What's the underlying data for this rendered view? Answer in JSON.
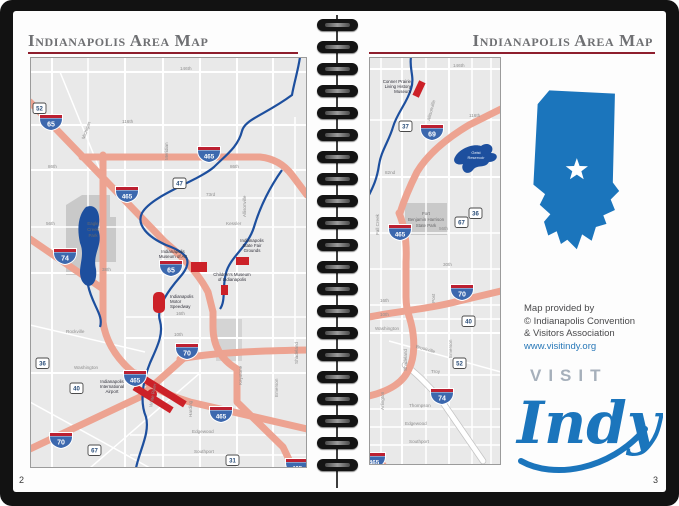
{
  "colors": {
    "cover": "#121212",
    "page": "#fdfdfd",
    "map_bg": "#e9e9e9",
    "highway_salmon": "#eda391",
    "river_blue": "#1d4f9e",
    "park_gray": "#c9c9c9",
    "poi_red": "#cc2128",
    "interstate_blue": "#3c68ae",
    "interstate_red": "#bc2031",
    "title_gray": "#6f7073",
    "rule_red": "#8e1e2d",
    "indiana_blue": "#1b75bc",
    "visit_gray": "#a6b0bb",
    "link_blue": "#2878b8"
  },
  "left": {
    "title": "Indianapolis Area Map",
    "page_number": "2",
    "map": {
      "parks": [
        {
          "name": "Eagle Creek Park",
          "lines": [
            "Eagle",
            "Creek",
            "Park"
          ]
        }
      ],
      "pois": [
        {
          "name": "Indianapolis Museum of Art",
          "lines": [
            "Indianapolis",
            "Museum of Art"
          ]
        },
        {
          "name": "Children's Museum of Indianapolis",
          "lines": [
            "Children's Museum",
            "of Indianapolis"
          ]
        },
        {
          "name": "Indianapolis Motor Speedway",
          "lines": [
            "Indianapolis",
            "Motor",
            "Speedway"
          ]
        },
        {
          "name": "Indianapolis State Fair Grounds",
          "lines": [
            "Indianapolis",
            "State Fair",
            "Grounds"
          ]
        },
        {
          "name": "Indianapolis International Airport",
          "lines": [
            "Indianapolis",
            "International",
            "Airport"
          ]
        }
      ],
      "interstate_shields": [
        "65",
        "465",
        "465",
        "74",
        "65",
        "70",
        "465",
        "465",
        "70",
        "465"
      ],
      "route_shields": [
        "52",
        "47",
        "36",
        "40",
        "67",
        "31"
      ],
      "roads": [
        "146th",
        "116th",
        "86th",
        "73rd",
        "Kessler",
        "38th",
        "16th",
        "10th",
        "Washington",
        "Rockville",
        "Michigan",
        "Meridian",
        "Keystone",
        "Allisonville",
        "White River",
        "Harding",
        "Edgewood",
        "Southport",
        "56th",
        "86th",
        "Emerson",
        "Shadeland"
      ]
    }
  },
  "right": {
    "title": "Indianapolis Area Map",
    "page_number": "3",
    "map": {
      "pois": [
        {
          "name": "Conner Prairie Living History Museum",
          "lines": [
            "Conner Prairie",
            "Living History",
            "Museum"
          ]
        },
        {
          "name": "Fort Benjamin Harrison State Park",
          "lines": [
            "Fort",
            "Benjamin Harrison",
            "State Park"
          ]
        },
        {
          "name": "Geist Reservoir",
          "lines": [
            "Geist",
            "Reservoir"
          ]
        }
      ],
      "interstate_shields": [
        "69",
        "465",
        "70",
        "74",
        "465"
      ],
      "route_shields": [
        "37",
        "36",
        "67",
        "40",
        "52"
      ],
      "roads": [
        "146th",
        "116th",
        "82nd",
        "56th",
        "30th",
        "16th",
        "10th",
        "Washington",
        "Brookville",
        "Troy",
        "Thompson",
        "Edgewood",
        "Southport",
        "Allisonville",
        "Fall Creek",
        "Post",
        "Emerson",
        "Shadeland",
        "Arlington"
      ]
    },
    "sidebar": {
      "credit_lines": [
        "Map provided by",
        "© Indianapolis Convention",
        "& Visitors Association"
      ],
      "credit_link": "www.visitindy.org",
      "logo_visit": "VISIT",
      "logo_indy": "Indy"
    }
  }
}
